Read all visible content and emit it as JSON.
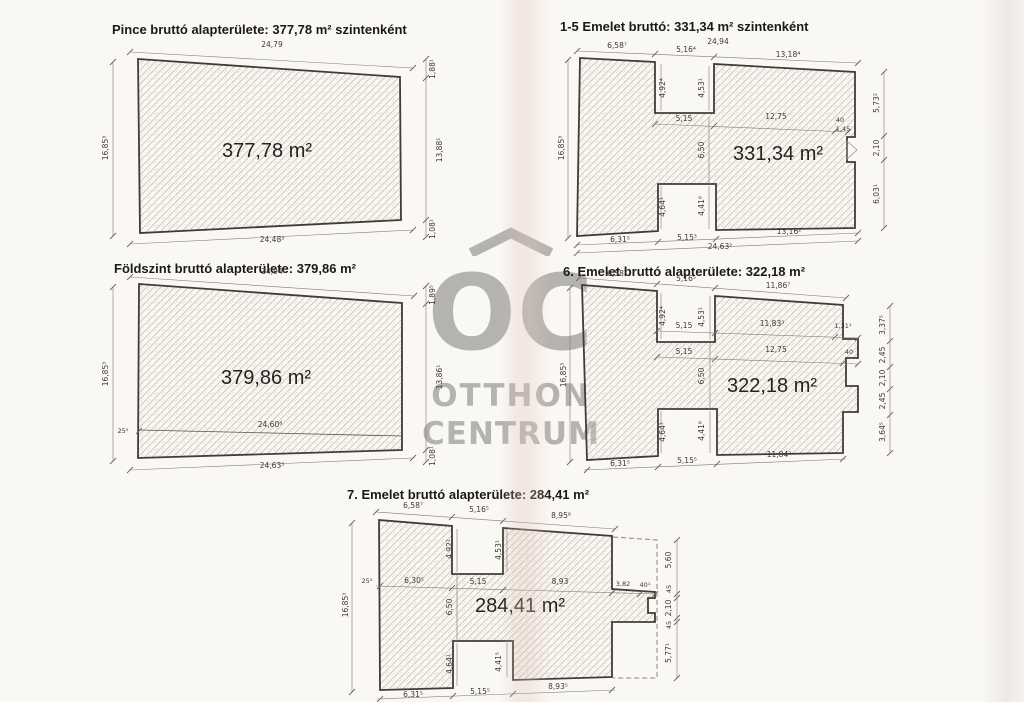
{
  "watermark": {
    "logo": "OC",
    "name_line1": "OTTHON",
    "name_line2": "CENTRUM",
    "color": "#a8a7a4"
  },
  "plans": {
    "pince": {
      "title": "Pince bruttó alapterülete: 377,78 m² szintenként",
      "area": "377,78 m²",
      "dims": {
        "top": "24,79",
        "left": "16,85³",
        "right_top": "1,88¹",
        "right": "13,88¹",
        "right_bottom": "1,08¹",
        "bottom": "24,48³"
      }
    },
    "foldszint": {
      "title": "Földszint bruttó alapterülete: 379,86 m²",
      "area": "379,86 m²",
      "dims": {
        "top": "24,94",
        "left": "16,85³",
        "left_step": "25⁵",
        "inner_bottom": "24,60⁸",
        "right_top": "1,89⁵",
        "right": "13,86¹",
        "right_bottom": "1,08¹",
        "bottom": "24,63³"
      }
    },
    "emelet1_5": {
      "title": "1-5 Emelet bruttó: 331,34 m² szintenként",
      "area": "331,34 m²",
      "dims": {
        "top_overall": "24,94",
        "top_left": "6,58⁷",
        "top_notch": "5,16⁴",
        "top_right": "13,18⁴",
        "notch_depth_left": "4,92⁴",
        "notch_depth_right": "4,53¹",
        "mid_left": "5,15",
        "mid_right": "12,75",
        "mid_step": "40",
        "mid_step2": "1,45",
        "left": "16,85³",
        "center_height": "6,50",
        "lower_notch_left": "4,64¹",
        "lower_notch_right": "4,41⁶",
        "bottom_left": "6,31⁵",
        "bottom_notch": "5,15³",
        "bottom_right": "13,16²",
        "bottom_overall": "24,63²",
        "right_top": "5,73²",
        "right_mid": "2,10",
        "right_bottom": "6,03¹"
      }
    },
    "emelet6": {
      "title": "6. Emelet bruttó alapterülete: 322,18 m²",
      "area": "322,18 m²",
      "dims": {
        "top_left": "6,58⁷",
        "top_notch": "5,16⁵",
        "top_right": "11,86⁷",
        "notch_depth_left": "4,92⁴",
        "notch_depth_right": "4,53¹",
        "row1_left": "5,15",
        "row1_mid": "11,83³",
        "row1_right": "1,31¹",
        "row2_left": "5,15",
        "row2_mid": "12,75",
        "row2_step": "40",
        "left": "16,85³",
        "center_height": "6,50",
        "lower_notch_left": "4,64¹",
        "lower_notch_right": "4,41⁶",
        "bottom_left": "6,31⁵",
        "bottom_notch": "5,15⁵",
        "bottom_right": "11,84²",
        "right_1": "3,37⁵",
        "right_2": "2,45",
        "right_3": "2,10",
        "right_4": "2,45",
        "right_5": "3,64⁵"
      }
    },
    "emelet7": {
      "title": "7. Emelet bruttó alapterülete: 284,41 m²",
      "area": "284,41 m²",
      "dims": {
        "top_left": "6,58⁷",
        "top_notch": "5,16⁵",
        "top_right": "8,95⁶",
        "notch_depth_left": "4,92²",
        "notch_depth_right": "4,53¹",
        "left_step": "25⁵",
        "row_left": "6,30⁵",
        "row_notch": "5,15",
        "row_right": "8,93",
        "row_step": "3,82",
        "row_step2": "40¹",
        "left": "16,85³",
        "center_height": "6,50",
        "lower_notch_left": "4,64¹",
        "lower_notch_right": "4,41⁵",
        "bottom_left": "6,31⁵",
        "bottom_notch": "5,15⁵",
        "bottom_right": "8,93⁵",
        "right_1": "5,60",
        "right_2": "45",
        "right_3": "2,10",
        "right_4": "45",
        "right_5": "5,77¹"
      }
    }
  }
}
